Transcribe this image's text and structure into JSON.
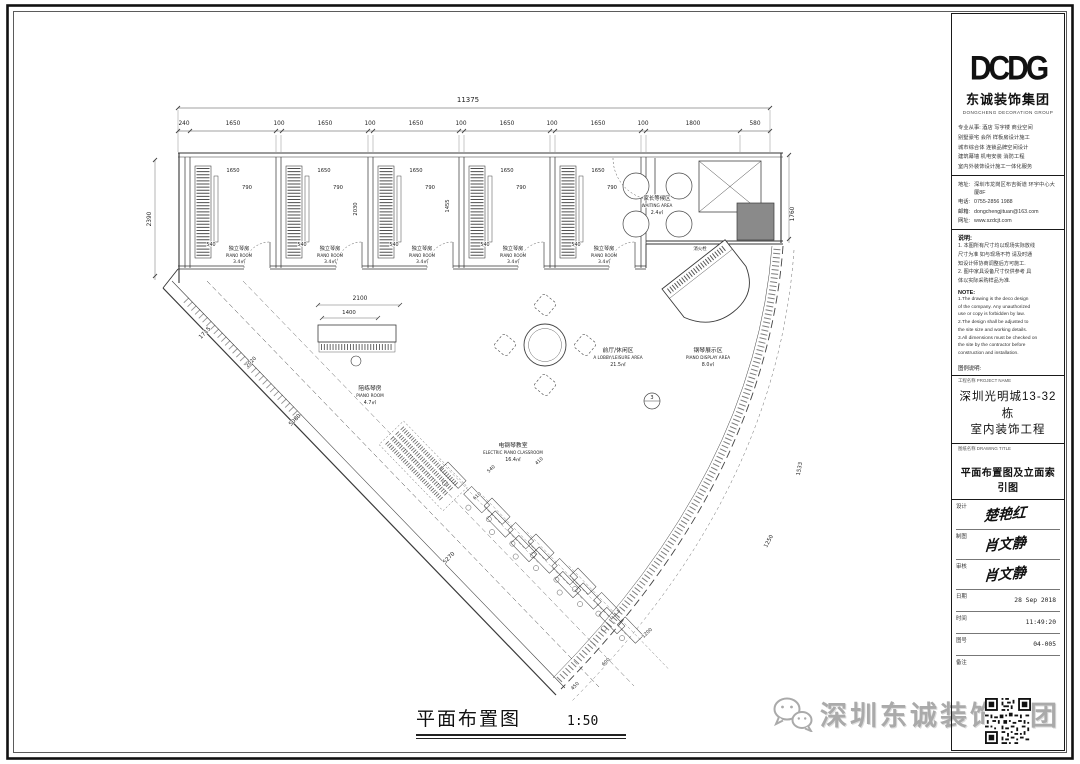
{
  "titleblock": {
    "logo_text": "DCDG",
    "company_cn": "东诚装饰集团",
    "company_en": "DONGCHENG DECORATION GROUP",
    "services": [
      "专业从事: 酒店 写字楼 商业空间",
      "别墅豪宅 会所 样板房设计施工",
      "城市综合体 连锁品牌空间设计",
      "建筑幕墙 机电安装 消防工程",
      "室内外装饰设计施工一体化服务"
    ],
    "contact": [
      {
        "label": "地址:",
        "value": "深圳市龙岗区布吉街道 环宇中心大厦8F"
      },
      {
        "label": "电话:",
        "value": "0755-2856 1988"
      },
      {
        "label": "邮箱:",
        "value": "dongchengjituan@163.com"
      },
      {
        "label": "网址:",
        "value": "www.szdcjt.com"
      }
    ],
    "notes_cn_title": "说明:",
    "notes_cn": [
      "1. 本图所有尺寸均以现场实际放线",
      "尺寸为准 如与现场不符 请及时通",
      "知设计师协商调整后方可施工.",
      "2. 图中家具设备尺寸仅供参考 具",
      "体以实际采购样品为准."
    ],
    "notes_en_title": "NOTE:",
    "notes_en": [
      "1.The drawing is the deco design",
      "of the company. Any unauthorized",
      "use or copy is forbidden by law.",
      "2.The design shall be adjusted to",
      "the site size and working details.",
      "3.All dimensions must be checked on",
      "the site by the contractor before",
      "construction and installation."
    ],
    "legend_title": "图例说明:",
    "project_label": "工程名称 PROJECT NAME",
    "project_name_line1": "深圳光明城13-32栋",
    "project_name_line2": "室内装饰工程",
    "drawing_label": "图纸名称 DRAWING TITLE",
    "drawing_title": "平面布置图及立面索引图",
    "signatures": [
      {
        "label": "设计",
        "value": "楚艳红"
      },
      {
        "label": "制图",
        "value": "肖文静"
      },
      {
        "label": "审核",
        "value": "肖文静"
      }
    ],
    "meta": [
      {
        "label": "日期",
        "value": "28 Sep 2018"
      },
      {
        "label": "时间",
        "value": "11:49:20"
      },
      {
        "label": "图号",
        "value": "04-005"
      },
      {
        "label": "备注",
        "value": ""
      }
    ]
  },
  "caption": {
    "title": "平面布置图",
    "scale": "1:50"
  },
  "watermark": {
    "text": "深圳东诚装饰集团"
  },
  "plan": {
    "labels": [
      {
        "t": "11375",
        "x": 468,
        "y": 102,
        "s": 7
      },
      {
        "t": "240",
        "x": 184,
        "y": 125,
        "s": 5.8
      },
      {
        "t": "1650",
        "x": 233,
        "y": 125,
        "s": 5.8
      },
      {
        "t": "100",
        "x": 279,
        "y": 125,
        "s": 5.8
      },
      {
        "t": "1650",
        "x": 325,
        "y": 125,
        "s": 5.8
      },
      {
        "t": "100",
        "x": 370,
        "y": 125,
        "s": 5.8
      },
      {
        "t": "1650",
        "x": 416,
        "y": 125,
        "s": 5.8
      },
      {
        "t": "100",
        "x": 461,
        "y": 125,
        "s": 5.8
      },
      {
        "t": "1650",
        "x": 507,
        "y": 125,
        "s": 5.8
      },
      {
        "t": "100",
        "x": 552,
        "y": 125,
        "s": 5.8
      },
      {
        "t": "1650",
        "x": 598,
        "y": 125,
        "s": 5.8
      },
      {
        "t": "100",
        "x": 643,
        "y": 125,
        "s": 5.8
      },
      {
        "t": "1800",
        "x": 693,
        "y": 125,
        "s": 5.8
      },
      {
        "t": "580",
        "x": 755,
        "y": 125,
        "s": 5.8
      },
      {
        "t": "2390",
        "x": 151,
        "y": 219,
        "s": 5.8,
        "r": -90
      },
      {
        "t": "1760",
        "x": 794,
        "y": 214,
        "s": 5.8,
        "r": -90
      },
      {
        "t": "1650",
        "x": 233,
        "y": 172,
        "s": 5.2
      },
      {
        "t": "790",
        "x": 247,
        "y": 189,
        "s": 5.2
      },
      {
        "t": "540",
        "x": 211,
        "y": 246,
        "s": 4.8
      },
      {
        "t": "独立琴房",
        "x": 239,
        "y": 250,
        "s": 5.2
      },
      {
        "t": "PIANO ROOM",
        "x": 239,
        "y": 257,
        "s": 4
      },
      {
        "t": "3.4㎡",
        "x": 239,
        "y": 263,
        "s": 4.6
      },
      {
        "t": "1650",
        "x": 324,
        "y": 172,
        "s": 5.2
      },
      {
        "t": "790",
        "x": 338,
        "y": 189,
        "s": 5.2
      },
      {
        "t": "540",
        "x": 302,
        "y": 246,
        "s": 4.8
      },
      {
        "t": "独立琴房",
        "x": 330,
        "y": 250,
        "s": 5.2
      },
      {
        "t": "PIANO ROOM",
        "x": 330,
        "y": 257,
        "s": 4
      },
      {
        "t": "3.4㎡",
        "x": 330,
        "y": 263,
        "s": 4.6
      },
      {
        "t": "1650",
        "x": 416,
        "y": 172,
        "s": 5.2
      },
      {
        "t": "790",
        "x": 430,
        "y": 189,
        "s": 5.2
      },
      {
        "t": "540",
        "x": 394,
        "y": 246,
        "s": 4.8
      },
      {
        "t": "独立琴房",
        "x": 422,
        "y": 250,
        "s": 5.2
      },
      {
        "t": "PIANO ROOM",
        "x": 422,
        "y": 257,
        "s": 4
      },
      {
        "t": "3.4㎡",
        "x": 422,
        "y": 263,
        "s": 4.6
      },
      {
        "t": "1650",
        "x": 507,
        "y": 172,
        "s": 5.2
      },
      {
        "t": "790",
        "x": 521,
        "y": 189,
        "s": 5.2
      },
      {
        "t": "540",
        "x": 485,
        "y": 246,
        "s": 4.8
      },
      {
        "t": "独立琴房",
        "x": 513,
        "y": 250,
        "s": 5.2
      },
      {
        "t": "PIANO ROOM",
        "x": 513,
        "y": 257,
        "s": 4
      },
      {
        "t": "3.4㎡",
        "x": 513,
        "y": 263,
        "s": 4.6
      },
      {
        "t": "1650",
        "x": 598,
        "y": 172,
        "s": 5.2
      },
      {
        "t": "790",
        "x": 612,
        "y": 189,
        "s": 5.2
      },
      {
        "t": "540",
        "x": 576,
        "y": 246,
        "s": 4.8
      },
      {
        "t": "独立琴房",
        "x": 604,
        "y": 250,
        "s": 5.2
      },
      {
        "t": "PIANO ROOM",
        "x": 604,
        "y": 257,
        "s": 4
      },
      {
        "t": "3.4㎡",
        "x": 604,
        "y": 263,
        "s": 4.6
      },
      {
        "t": "2030",
        "x": 357,
        "y": 209,
        "s": 5.2,
        "r": -90
      },
      {
        "t": "1455",
        "x": 449,
        "y": 206,
        "s": 5.2,
        "r": -90
      },
      {
        "t": "家长等候区",
        "x": 657,
        "y": 200,
        "s": 5.4
      },
      {
        "t": "WAITING AREA",
        "x": 657,
        "y": 207,
        "s": 4.2
      },
      {
        "t": "2.4㎡",
        "x": 657,
        "y": 214,
        "s": 4.8
      },
      {
        "t": "消火栓",
        "x": 700,
        "y": 250,
        "s": 4.4
      },
      {
        "t": "前厅/休闲区",
        "x": 618,
        "y": 352,
        "s": 5.8
      },
      {
        "t": "A LOBBY/LEISURE AREA",
        "x": 618,
        "y": 359,
        "s": 4.2
      },
      {
        "t": "21.5㎡",
        "x": 618,
        "y": 366,
        "s": 4.8
      },
      {
        "t": "钢琴展示区",
        "x": 708,
        "y": 352,
        "s": 5.8
      },
      {
        "t": "PIANO DISPLAY AREA",
        "x": 708,
        "y": 359,
        "s": 4.2
      },
      {
        "t": "8.0㎡",
        "x": 708,
        "y": 366,
        "s": 4.8
      },
      {
        "t": "陪练琴房",
        "x": 370,
        "y": 390,
        "s": 5.8
      },
      {
        "t": "PIANO ROOM",
        "x": 370,
        "y": 397,
        "s": 4.2
      },
      {
        "t": "4.7㎡",
        "x": 370,
        "y": 404,
        "s": 4.8
      },
      {
        "t": "电钢琴教室",
        "x": 513,
        "y": 447,
        "s": 5.8
      },
      {
        "t": "ELECTRIC PIANO CLASSROOM",
        "x": 513,
        "y": 454,
        "s": 4
      },
      {
        "t": "16.4㎡",
        "x": 513,
        "y": 461,
        "s": 4.8
      },
      {
        "t": "2100",
        "x": 360,
        "y": 300,
        "s": 5.8
      },
      {
        "t": "1400",
        "x": 349,
        "y": 314,
        "s": 5.4
      },
      {
        "t": "1715",
        "x": 206,
        "y": 334,
        "s": 5.6,
        "r": -46
      },
      {
        "t": "2020",
        "x": 252,
        "y": 363,
        "s": 5,
        "r": -46
      },
      {
        "t": "5080",
        "x": 296,
        "y": 421,
        "s": 5.6,
        "r": -46
      },
      {
        "t": "5270",
        "x": 450,
        "y": 559,
        "s": 5.6,
        "r": -46
      },
      {
        "t": "540",
        "x": 492,
        "y": 470,
        "s": 4.6,
        "r": -42
      },
      {
        "t": "610",
        "x": 478,
        "y": 497,
        "s": 4.6,
        "r": -42
      },
      {
        "t": "410",
        "x": 540,
        "y": 462,
        "s": 4.6,
        "r": -42
      },
      {
        "t": "1533",
        "x": 801,
        "y": 469,
        "s": 5.4,
        "r": -80
      },
      {
        "t": "1250",
        "x": 770,
        "y": 542,
        "s": 5.4,
        "r": -62
      },
      {
        "t": "1200",
        "x": 648,
        "y": 634,
        "s": 4.8,
        "r": -44
      },
      {
        "t": "600",
        "x": 607,
        "y": 663,
        "s": 4.8,
        "r": -45
      },
      {
        "t": "450",
        "x": 576,
        "y": 687,
        "s": 4.8,
        "r": -45
      },
      {
        "t": "3",
        "x": 652,
        "y": 399,
        "s": 5
      }
    ]
  }
}
